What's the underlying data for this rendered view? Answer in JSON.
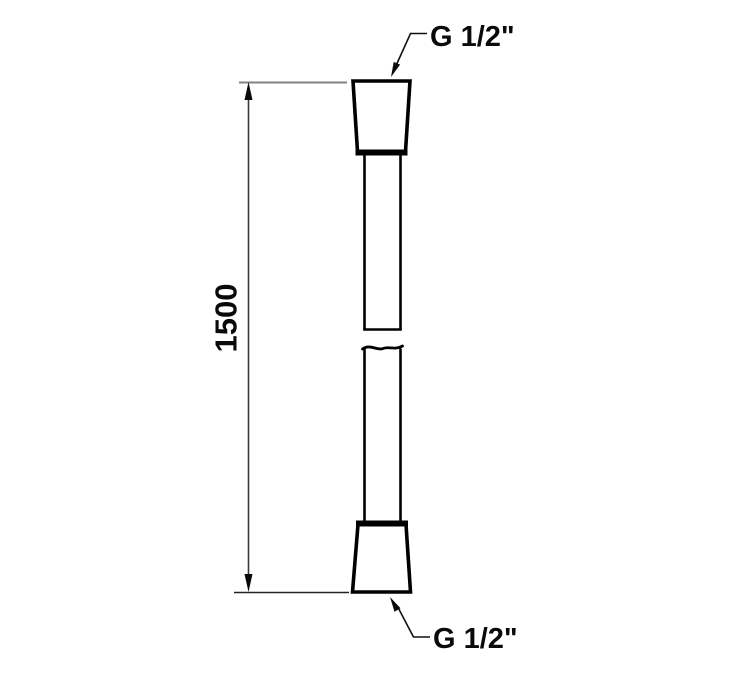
{
  "drawing": {
    "dimension": {
      "value": "1500"
    },
    "labels": {
      "top_connection": "G 1/2\"",
      "bottom_connection": "G 1/2\""
    },
    "colors": {
      "outline": "#000000",
      "dimension_line": "#3a3a3a",
      "extension_line_top": "#808080",
      "extension_line_bottom": "#222222",
      "text": "#0a0a0a",
      "background": "#ffffff"
    }
  }
}
